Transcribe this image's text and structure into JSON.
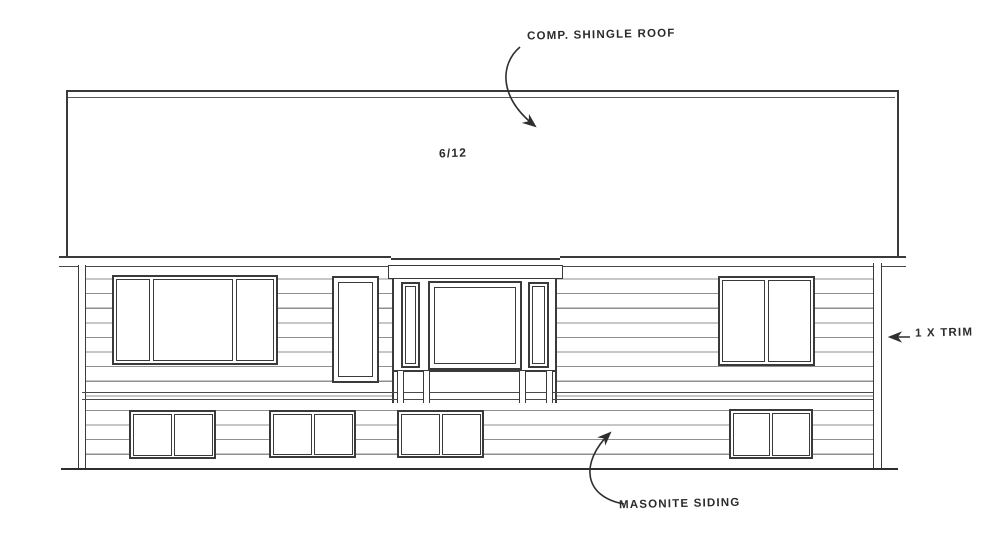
{
  "annotations": {
    "roof_material": "COMP. SHINGLE ROOF",
    "roof_pitch": "6/12",
    "trim_note": "1 X TRIM",
    "siding_note": "MASONITE SIDING"
  },
  "colors": {
    "ink": "#3a3a3a",
    "ink_light": "#8f8f8f",
    "paper": "#ffffff"
  }
}
